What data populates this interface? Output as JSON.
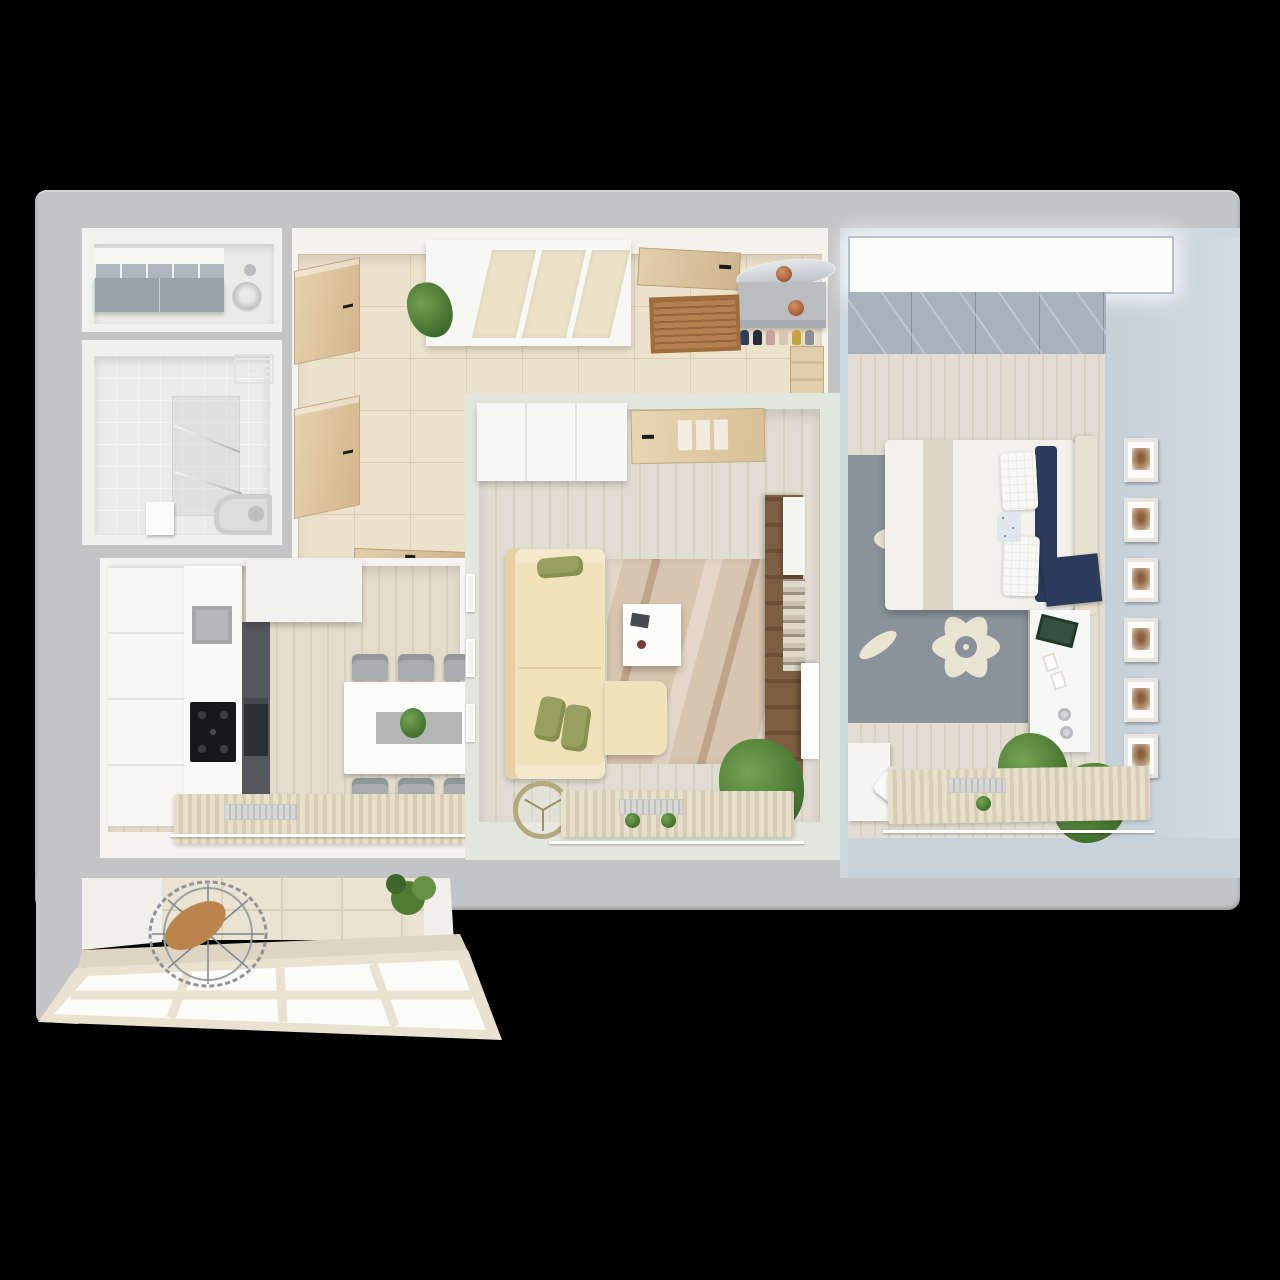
{
  "scene": {
    "title": "Two-room apartment 3D floor plan, top view",
    "background_color": "#000000",
    "slab_color": "#c3c4c6",
    "inner_wall_color": "#f2f2f0",
    "window_light_color": "#fbfbf7"
  },
  "rooms": [
    {
      "id": "storage",
      "name": "Storage room",
      "wall_color": "#f1f1ef",
      "floor_color": "#eaeae7",
      "furniture": [
        "storage-cabinet",
        "cubby-shelf",
        "washing-machine"
      ]
    },
    {
      "id": "bathroom",
      "name": "Bathroom",
      "wall_color": "#f0f0ee",
      "floor_color": "#ebebe9",
      "furniture": [
        "shower-glass",
        "towel-rails",
        "wire-basket-shelf",
        "sink",
        "bathtub"
      ]
    },
    {
      "id": "hallway",
      "name": "Hallway",
      "wall_color": "#f4f2ec",
      "floor_color": "#ece1cb",
      "furniture": [
        "sliding-wardrobe",
        "potted-plant",
        "entry-door",
        "doormat",
        "shoe-console",
        "shoes",
        "oval-mirror",
        "vases",
        "side-doors",
        "kitchen-door"
      ]
    },
    {
      "id": "kitchen",
      "name": "Kitchen",
      "wall_color": "#f4f3f1",
      "floor_color": "#ddd6c6",
      "furniture": [
        "cabinet-column",
        "countertop",
        "sink",
        "gas-hob",
        "oven-tall-unit",
        "upper-cabinets",
        "dining-table",
        "table-runner",
        "plant-centerpiece",
        "six-chairs",
        "curtains",
        "radiator",
        "curtain-rail"
      ]
    },
    {
      "id": "living",
      "name": "Living room",
      "wall_color": "#e3e6dc",
      "floor_color": "#dbd7cc",
      "furniture": [
        "white-closet",
        "interior-door",
        "corner-sofa",
        "olive-cushions",
        "headrest-pillow",
        "area-rug",
        "coffee-table",
        "magazine",
        "cup",
        "tv-wall-panel",
        "tv-cabinet",
        "magazine-shelf",
        "tv",
        "floor-fan",
        "potted-plant",
        "curtains",
        "radiator",
        "curtain-rail",
        "wall-frames"
      ]
    },
    {
      "id": "bedroom",
      "name": "Bedroom",
      "wall_color": "#cdd7de",
      "floor_color": "#ddd8cc",
      "furniture": [
        "wardrobe-light-band",
        "sliding-closet-top",
        "double-bed",
        "folded-blanket",
        "navy-pillows",
        "white-pillows",
        "patterned-pillow",
        "headboard",
        "navy-throw",
        "floral-rug",
        "dresser-desk",
        "magazine",
        "photo-frames-small",
        "cups",
        "picture-frames-wall",
        "potted-plants",
        "corner-desk",
        "desk-chair",
        "curtains",
        "radiator",
        "curtain-rail"
      ]
    },
    {
      "id": "balcony",
      "name": "Balcony",
      "wall_color": "#efece6",
      "floor_color": "#ddd5c2",
      "furniture": [
        "hanging-rattan-chair",
        "potted-plant",
        "panoramic-window"
      ]
    }
  ],
  "palette": {
    "wood_door": "#d9c4a3",
    "tile_line": "#d9cdb2",
    "sofa_beige": "#f2e2bc",
    "cushion_olive": "#97a05e",
    "rug_living": "#d8c5b0",
    "rug_bedroom_base": "#8a939b",
    "rug_bedroom_flower": "#e9e3d2",
    "navy": "#2c3b5c",
    "dark_unit": "#54585c",
    "hob_black": "#17181a",
    "plant_green": "#4a7a36",
    "closet_gray_blue": "#a8b2bc",
    "mat_brown": "#b5804f"
  },
  "shoes_colors": [
    "#2e3d5e",
    "#252b38",
    "#c79f9f",
    "#d9c6b2",
    "#c8a23c",
    "#8a8f94"
  ]
}
